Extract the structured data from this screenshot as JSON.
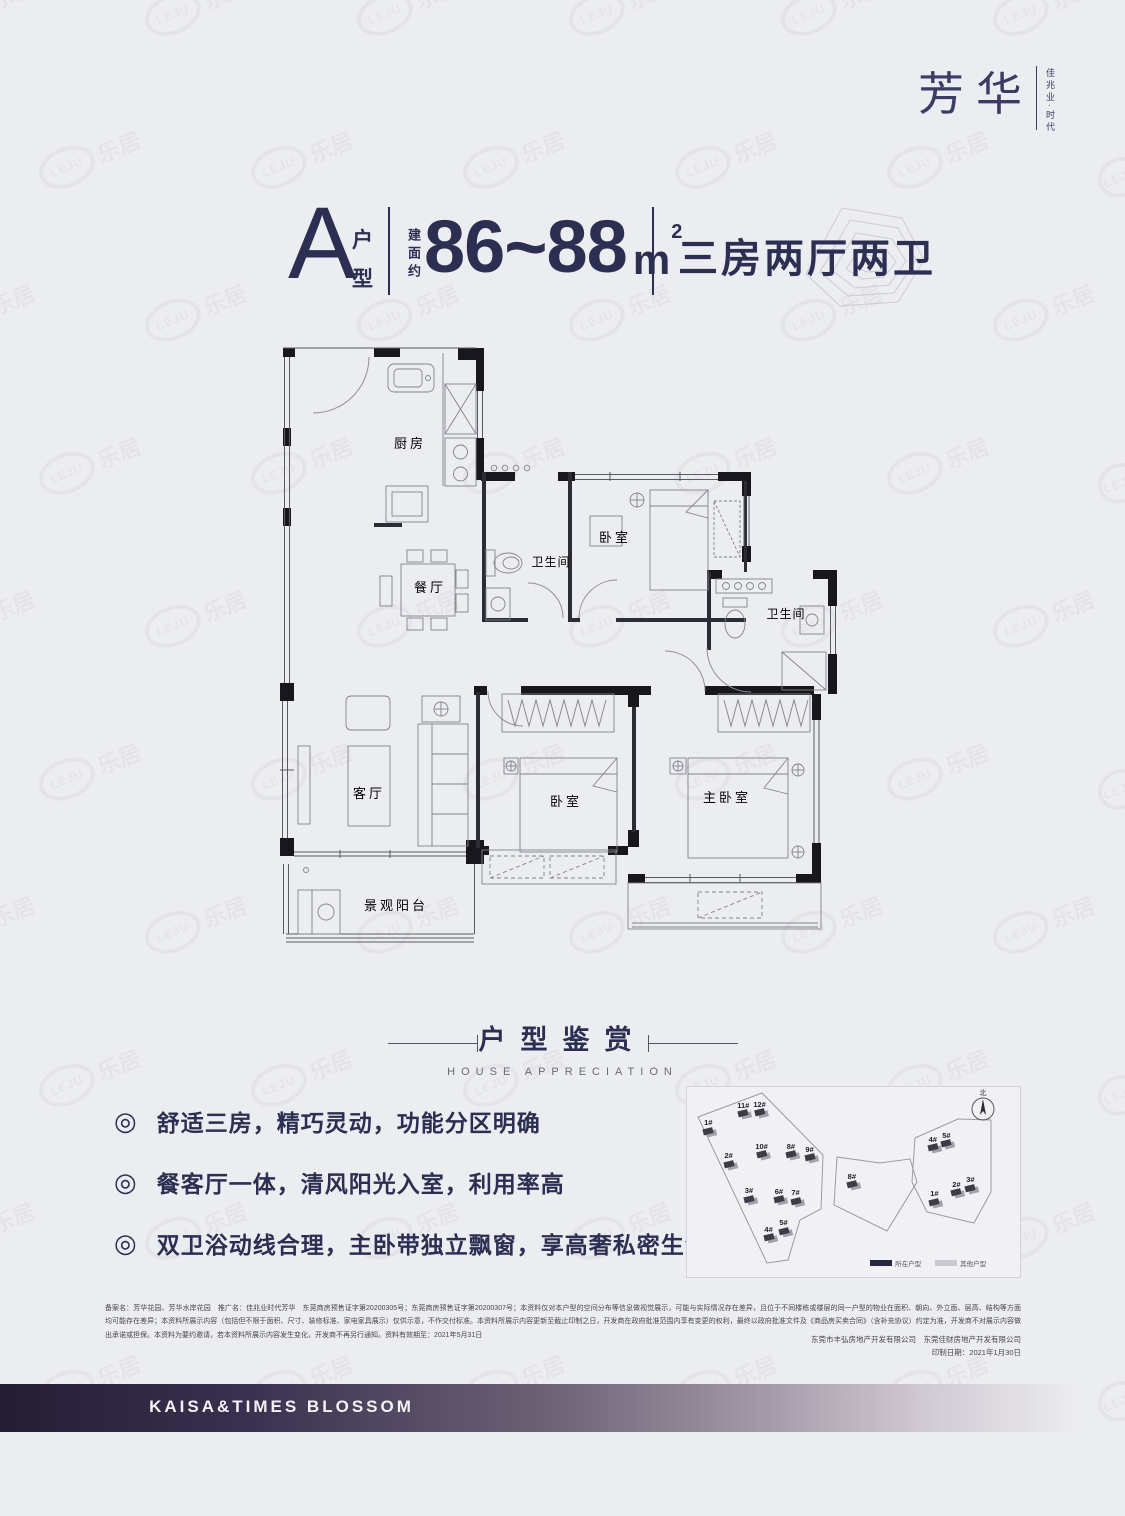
{
  "ui": {
    "bullet": "◎"
  },
  "logo": {
    "main": "芳华",
    "sub": "佳兆业·时代"
  },
  "title": {
    "unit_letter": "A",
    "unit_label_top": "户",
    "unit_label_bottom": "型",
    "area_label": "建面约",
    "area_value": "86~88",
    "area_unit": "m",
    "area_exp": "2",
    "layout_text": "三房两厅两卫"
  },
  "floorplan": {
    "rooms": [
      {
        "label": "厨房"
      },
      {
        "label": "餐厅"
      },
      {
        "label": "卫生间"
      },
      {
        "label": "卧室"
      },
      {
        "label": "卫生间"
      },
      {
        "label": "客厅"
      },
      {
        "label": "卧室"
      },
      {
        "label": "主卧室"
      },
      {
        "label": "景观阳台"
      }
    ]
  },
  "section": {
    "title_cn": "户型鉴赏",
    "title_en": "HOUSE APPRECIATION"
  },
  "features": [
    "舒适三房，精巧灵动，功能分区明确",
    "餐客厅一体，清风阳光入室，利用率高",
    "双卫浴动线合理，主卧带独立飘窗，享高奢私密生活"
  ],
  "sitemap": {
    "north_label": "北",
    "legend": [
      {
        "label": "所在户型",
        "color": "#262640"
      },
      {
        "label": "其他户型",
        "color": "#c9c9d1"
      }
    ],
    "buildings": [
      {
        "id": "1#",
        "x": 6.4,
        "y": 20
      },
      {
        "id": "11#",
        "x": 16.9,
        "y": 11
      },
      {
        "id": "12#",
        "x": 21.8,
        "y": 10.5
      },
      {
        "id": "2#",
        "x": 12.5,
        "y": 37.5
      },
      {
        "id": "10#",
        "x": 22.4,
        "y": 32.5
      },
      {
        "id": "8#",
        "x": 31.2,
        "y": 32.5
      },
      {
        "id": "9#",
        "x": 36.8,
        "y": 34.2
      },
      {
        "id": "3#",
        "x": 18.6,
        "y": 55.8
      },
      {
        "id": "6#",
        "x": 27.6,
        "y": 56.3
      },
      {
        "id": "7#",
        "x": 32.6,
        "y": 57
      },
      {
        "id": "4#",
        "x": 24.5,
        "y": 76.3
      },
      {
        "id": "5#",
        "x": 29,
        "y": 72.8
      },
      {
        "id": "8#",
        "x": 49.5,
        "y": 48.3
      },
      {
        "id": "4#",
        "x": 73.8,
        "y": 28.7
      },
      {
        "id": "5#",
        "x": 77.9,
        "y": 26.7
      },
      {
        "id": "2#",
        "x": 80.9,
        "y": 52.5
      },
      {
        "id": "3#",
        "x": 85.1,
        "y": 50
      },
      {
        "id": "1#",
        "x": 74.3,
        "y": 57.5
      }
    ]
  },
  "disclaimer": {
    "body": "备案名：芳华花园、芳华水岸花园　推广名：佳兆业时代芳华　东莞商房预售证字第20200305号；东莞商房预售证字第20200307号；本资料仅对本户型的空间分布等信息做视觉展示，可能与实际情况存在差异，且位于不同楼栋或楼层的同一户型的物业在面积、朝向、外立面、层高、结构等方面均可能存在差异；本资料所展示内容（包括但不限于面积、尺寸、装修标准、家电家具展示）仅供示意，不作交付标准。本资料所展示内容更新至截止印制之日，开发商在政府批准范围内享有变更的权利，最终以政府批准文件及《商品房买卖合同》（含补充协议）约定为准，开发商不对展示内容做出承诺或担保。本资料为要约邀请，若本资料所展示内容发生变化，开发商不再另行通知。资料有效期至：2021年5月31日",
    "company": "东莞市丰弘房地产开发有限公司　东莞佳财房地产开发有限公司",
    "print_date": "印制日期：2021年1月30日"
  },
  "footer": {
    "brand": "KAISA&TIMES BLOSSOM"
  },
  "watermark": {
    "cn": "乐居",
    "en": "LEJU"
  }
}
